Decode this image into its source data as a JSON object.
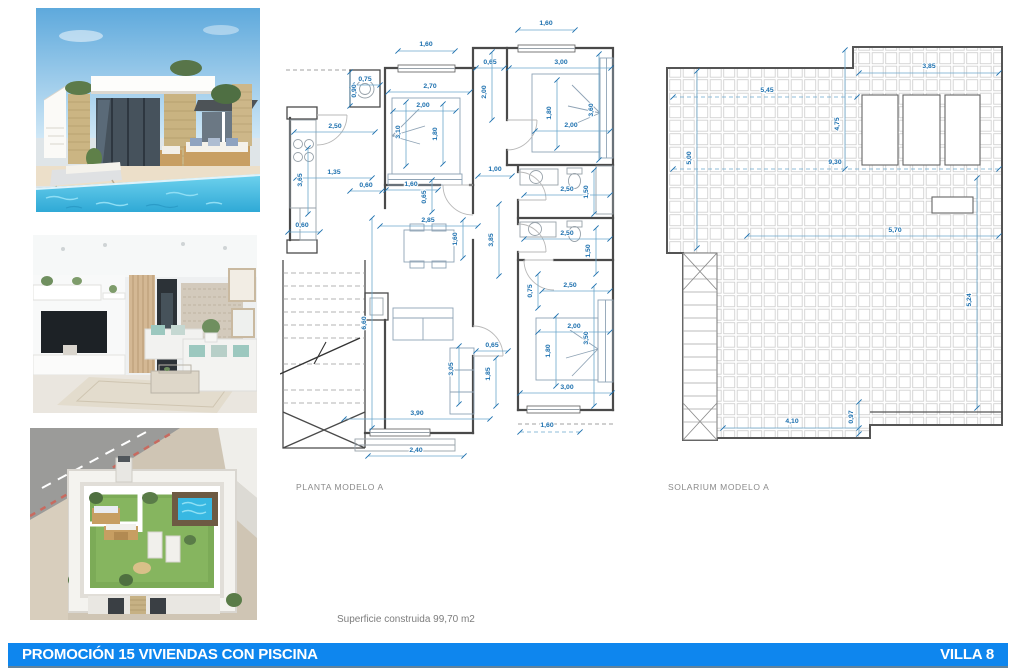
{
  "footer": {
    "left": "PROMOCIÓN 15 VIVIENDAS CON PISCINA",
    "right": "VILLA 8",
    "bg": "#0e86ee"
  },
  "surface_note": "Superficie construida 99,70 m2",
  "photos": [
    {
      "name": "villa-exterior-pool"
    },
    {
      "name": "living-room-interior"
    },
    {
      "name": "rooftop-solarium-aerial"
    }
  ],
  "colors": {
    "dim_text": "#1b6fae",
    "dim_line": "#6ba7cc",
    "wall": "#4a4a4a",
    "accent_blue": "#0e86ee"
  },
  "plans": {
    "planta": {
      "label": "PLANTA MODELO A",
      "dims": [
        {
          "t": "1,60",
          "x": 266,
          "y": 17,
          "l": [
            238,
            22,
            295,
            22
          ]
        },
        {
          "t": "1,60",
          "x": 146,
          "y": 38,
          "l": [
            118,
            43,
            175,
            43
          ]
        },
        {
          "t": "0,65",
          "x": 210,
          "y": 56,
          "l": [
            196,
            60,
            224,
            60
          ]
        },
        {
          "t": "3,00",
          "x": 281,
          "y": 56,
          "l": [
            229,
            60,
            331,
            60
          ]
        },
        {
          "t": "0,75",
          "x": 85,
          "y": 73,
          "l": [
            72,
            77,
            100,
            77
          ]
        },
        {
          "t": "0,90",
          "x": 76,
          "y": 83,
          "r": -90,
          "l": [
            70,
            64,
            70,
            98
          ]
        },
        {
          "t": "2,70",
          "x": 150,
          "y": 80,
          "l": [
            108,
            84,
            190,
            84
          ]
        },
        {
          "t": "2,00",
          "x": 206,
          "y": 84,
          "r": -90,
          "l": [
            212,
            44,
            212,
            112
          ]
        },
        {
          "t": "2,00",
          "x": 143,
          "y": 99,
          "l": [
            113,
            103,
            176,
            103
          ]
        },
        {
          "t": "1,80",
          "x": 271,
          "y": 105,
          "r": -90,
          "l": [
            277,
            72,
            277,
            140
          ]
        },
        {
          "t": "3,60",
          "x": 313,
          "y": 102,
          "r": -90,
          "l": [
            319,
            46,
            319,
            152
          ]
        },
        {
          "t": "2,00",
          "x": 291,
          "y": 119,
          "l": [
            255,
            123,
            330,
            123
          ]
        },
        {
          "t": "2,50",
          "x": 55,
          "y": 120,
          "l": [
            14,
            124,
            95,
            124
          ]
        },
        {
          "t": "3,10",
          "x": 120,
          "y": 124,
          "r": -90,
          "l": [
            126,
            94,
            126,
            158
          ]
        },
        {
          "t": "1,80",
          "x": 157,
          "y": 126,
          "r": -90,
          "l": [
            163,
            96,
            163,
            156
          ]
        },
        {
          "t": "1,35",
          "x": 54,
          "y": 166,
          "l": [
            16,
            170,
            92,
            170
          ]
        },
        {
          "t": "3,65",
          "x": 22,
          "y": 172,
          "r": -90,
          "l": [
            28,
            140,
            28,
            206
          ]
        },
        {
          "t": "0,60",
          "x": 86,
          "y": 179,
          "l": [
            70,
            183,
            102,
            183
          ]
        },
        {
          "t": "1,60",
          "x": 131,
          "y": 178,
          "l": [
            106,
            182,
            158,
            182
          ]
        },
        {
          "t": "0,65",
          "x": 146,
          "y": 189,
          "r": -90,
          "l": [
            152,
            172,
            152,
            204
          ]
        },
        {
          "t": "1,00",
          "x": 215,
          "y": 163,
          "l": [
            198,
            168,
            232,
            168
          ]
        },
        {
          "t": "2,50",
          "x": 287,
          "y": 183,
          "l": [
            244,
            187,
            330,
            187
          ]
        },
        {
          "t": "1,50",
          "x": 308,
          "y": 184,
          "r": -90,
          "l": [
            314,
            162,
            314,
            206
          ]
        },
        {
          "t": "0,60",
          "x": 22,
          "y": 219,
          "l": [
            8,
            224,
            40,
            224
          ]
        },
        {
          "t": "2,85",
          "x": 148,
          "y": 214,
          "l": [
            100,
            218,
            198,
            218
          ]
        },
        {
          "t": "1,60",
          "x": 177,
          "y": 231,
          "r": -90,
          "l": [
            183,
            212,
            183,
            250
          ]
        },
        {
          "t": "3,85",
          "x": 213,
          "y": 232,
          "r": -90,
          "l": [
            219,
            196,
            219,
            268
          ]
        },
        {
          "t": "2,50",
          "x": 287,
          "y": 227,
          "l": [
            244,
            231,
            330,
            231
          ]
        },
        {
          "t": "1,50",
          "x": 310,
          "y": 243,
          "r": -90,
          "l": [
            316,
            220,
            316,
            266
          ]
        },
        {
          "t": "0,75",
          "x": 252,
          "y": 283,
          "r": -90,
          "l": [
            258,
            266,
            258,
            300
          ]
        },
        {
          "t": "2,50",
          "x": 290,
          "y": 279,
          "l": [
            262,
            283,
            330,
            283
          ]
        },
        {
          "t": "6,60",
          "x": 86,
          "y": 315,
          "r": -90,
          "l": [
            92,
            210,
            92,
            420
          ]
        },
        {
          "t": "2,00",
          "x": 294,
          "y": 320,
          "l": [
            258,
            324,
            330,
            324
          ]
        },
        {
          "t": "3,50",
          "x": 308,
          "y": 330,
          "r": -90,
          "l": [
            314,
            278,
            314,
            398
          ]
        },
        {
          "t": "1,80",
          "x": 270,
          "y": 343,
          "r": -90,
          "l": [
            276,
            308,
            276,
            378
          ]
        },
        {
          "t": "0,65",
          "x": 212,
          "y": 339,
          "l": [
            196,
            343,
            228,
            343
          ]
        },
        {
          "t": "1,85",
          "x": 210,
          "y": 366,
          "r": -90,
          "l": [
            216,
            350,
            216,
            398
          ]
        },
        {
          "t": "3,05",
          "x": 173,
          "y": 361,
          "r": -90,
          "l": [
            179,
            338,
            179,
            396
          ]
        },
        {
          "t": "3,00",
          "x": 287,
          "y": 381,
          "l": [
            240,
            385,
            332,
            385
          ]
        },
        {
          "t": "3,90",
          "x": 137,
          "y": 407,
          "l": [
            64,
            411,
            210,
            411
          ]
        },
        {
          "t": "1,60",
          "x": 267,
          "y": 419,
          "l": [
            240,
            424,
            300,
            424
          ],
          "dash": true
        },
        {
          "t": "2,40",
          "x": 136,
          "y": 444,
          "l": [
            88,
            448,
            184,
            448
          ]
        }
      ]
    },
    "solarium": {
      "label": "SOLARIUM MODELO A",
      "dims": [
        {
          "t": "3,85",
          "x": 274,
          "y": 30,
          "l": [
            204,
            35,
            344,
            35
          ]
        },
        {
          "t": "5,45",
          "x": 112,
          "y": 54,
          "l": [
            18,
            59,
            202,
            59
          ],
          "dash": true
        },
        {
          "t": "4,75",
          "x": 184,
          "y": 86,
          "r": -90,
          "l": [
            190,
            12,
            190,
            131
          ]
        },
        {
          "t": "5,00",
          "x": 36,
          "y": 120,
          "r": -90,
          "l": [
            42,
            33,
            42,
            210
          ]
        },
        {
          "t": "9,30",
          "x": 180,
          "y": 126,
          "l": [
            18,
            131,
            344,
            131
          ],
          "dash": true
        },
        {
          "t": "5,70",
          "x": 240,
          "y": 194,
          "l": [
            92,
            198,
            344,
            198
          ]
        },
        {
          "t": "5,24",
          "x": 316,
          "y": 262,
          "r": -90,
          "l": [
            322,
            140,
            322,
            370
          ]
        },
        {
          "t": "4,10",
          "x": 137,
          "y": 385,
          "l": [
            68,
            390,
            204,
            390
          ]
        },
        {
          "t": "0,97",
          "x": 198,
          "y": 379,
          "r": -90,
          "l": [
            204,
            364,
            204,
            396
          ]
        }
      ]
    }
  }
}
